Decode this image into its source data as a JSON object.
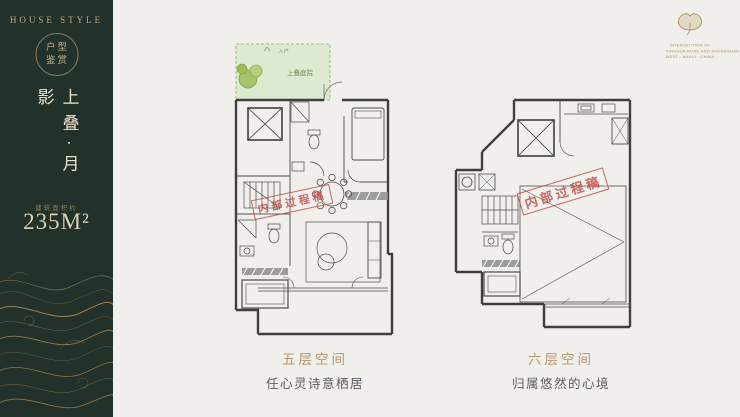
{
  "sidebar": {
    "brand": "HOUSE STYLE",
    "emblem_top": "户型",
    "emblem_bottom": "鉴赏",
    "product_name": "上叠·月影",
    "area_caption": "建筑面积约",
    "area_value": "235M²"
  },
  "header_logo": {
    "tagline_line1": "INTERSECTION OF",
    "tagline_line2": "XINGHUA ROAD AND ZHONGSHAN ROAD",
    "tagline_line3": "WEST · ANHUI · CHINA"
  },
  "plan_left": {
    "courtyard_entry": "入户",
    "courtyard_label": "上叠庭院",
    "watermark": "内部过程稿",
    "caption_title": "五层空间",
    "caption_subtitle": "任心灵诗意栖居"
  },
  "plan_right": {
    "watermark": "内部过程稿",
    "caption_title": "六层空间",
    "caption_subtitle": "归属悠然的心境"
  },
  "colors": {
    "sidebar_bg": "#22312a",
    "gold": "#c4ad85",
    "area_text": "#d9cfb6",
    "page_bg": "#f1efec",
    "courtyard_fill": "#dcead0",
    "courtyard_border": "#9cb97e",
    "watermark_red": "#c0453c",
    "caption_gold": "#b3996d",
    "caption_gray": "#5b5c60",
    "plan_line": "#4c4c4c"
  }
}
